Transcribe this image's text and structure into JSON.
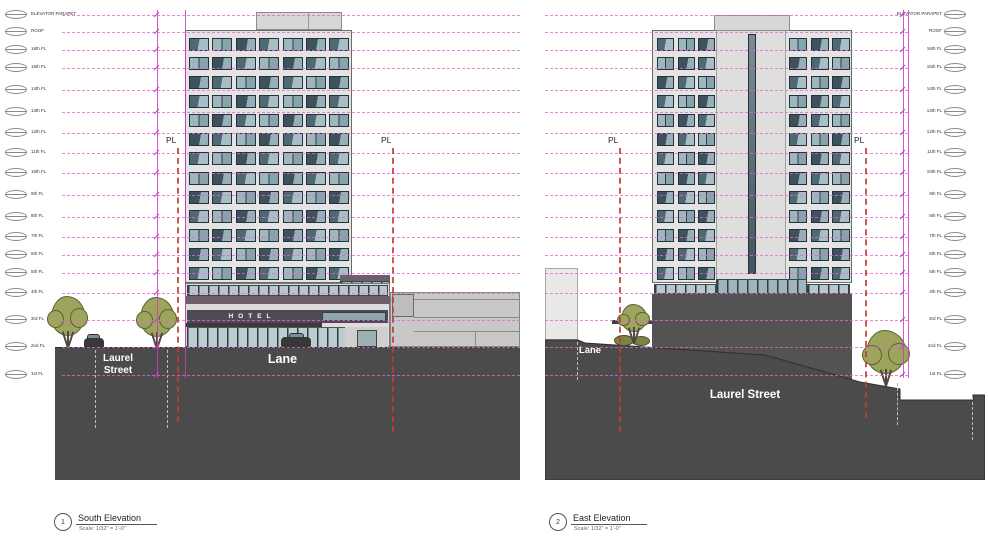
{
  "levels": {
    "labels": [
      "ELEVATOR PARAPET",
      "ROOF",
      "16th FL",
      "15th FL",
      "14th FL",
      "13th FL",
      "12th FL",
      "11th FL",
      "10th FL",
      "9th FL",
      "8th FL",
      "7th FL",
      "6th FL",
      "5th FL",
      "4th FL",
      "3rd FL",
      "2nd FL",
      "1st FL"
    ]
  },
  "south": {
    "pl_left": "PL",
    "pl_right": "PL",
    "hotel_sign": "HOTEL",
    "street_label_line1": "Laurel",
    "street_label_line2": "Street",
    "lane_label": "Lane",
    "title_number": "1",
    "title_name": "South Elevation",
    "title_scale": "Scale: 1/32\" = 1'-0\""
  },
  "east": {
    "pl_left": "PL",
    "pl_right": "PL",
    "lane_label": "Lane",
    "street_label": "Laurel Street",
    "ave_label": "W 8th Ave",
    "title_number": "2",
    "title_name": "East Elevation",
    "title_scale": "Scale: 1/32\" = 1'-0\""
  },
  "colors": {
    "grid_magenta": "#e268d6",
    "dimension_magenta": "#c93ec1",
    "property_line_red": "#c23b35",
    "ground_gray": "#4b4b4b",
    "facade_gray": "#e4e4e4",
    "podium_mauve": "#6d5e69",
    "glass_light": "#a7bec4",
    "glass_dark": "#3d525c",
    "tree_green": "#9ea35e"
  }
}
